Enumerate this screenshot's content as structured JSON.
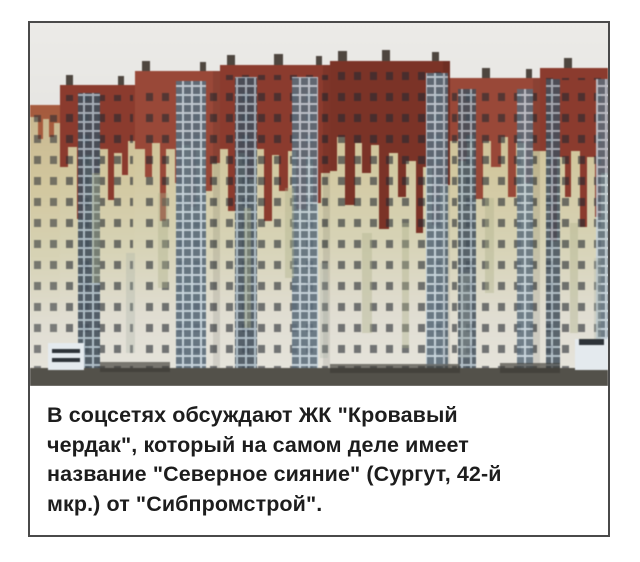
{
  "card": {
    "photo": {
      "alt": "Аэрофото жилого комплекса: верхние этажи высоток окрашены тёмно-красным с подтёками, стекающими вниз по фасадам, как кровь"
    },
    "caption": {
      "lines": [
        "В соцсетях обсуждают ЖК \"Кровавый",
        "чердак\", который на самом деле имеет",
        "название \"Северное сияние\" (Сургут, 42-й",
        "мкр.) от \"Сибпромстрой\"."
      ]
    }
  },
  "colors": {
    "page_bg": "#ffffff",
    "card_bg": "#ffffff",
    "frame": "#4a4a4a",
    "text": "#1d1d1d",
    "sky_top": "#ecebe8",
    "sky_bottom": "#d6d5d1",
    "blood_red": "#8e3a2c",
    "blood_red_light": "#9c4736",
    "blood_red_dark": "#7e3226",
    "drip_orange": "#a34a2e",
    "facade_tan": "#c9b68d",
    "facade_gold": "#d3c79c",
    "facade_olive": "#d6d2b2",
    "facade_pale": "#e0ddd0",
    "facade_white": "#e6e4dc",
    "streak_olive": "#b0b28a",
    "streak_gray": "#a4aea6",
    "window_dark": "#252a31",
    "glass_blue": "#a9bac6",
    "glass_pane": "#414f5c",
    "glass_blue_light": "#c3d2dc",
    "glass_pane_light": "#5b6d7c",
    "roof_vent": "#4e463f",
    "ground": "#53514a",
    "hut_white": "#e4eaee"
  }
}
